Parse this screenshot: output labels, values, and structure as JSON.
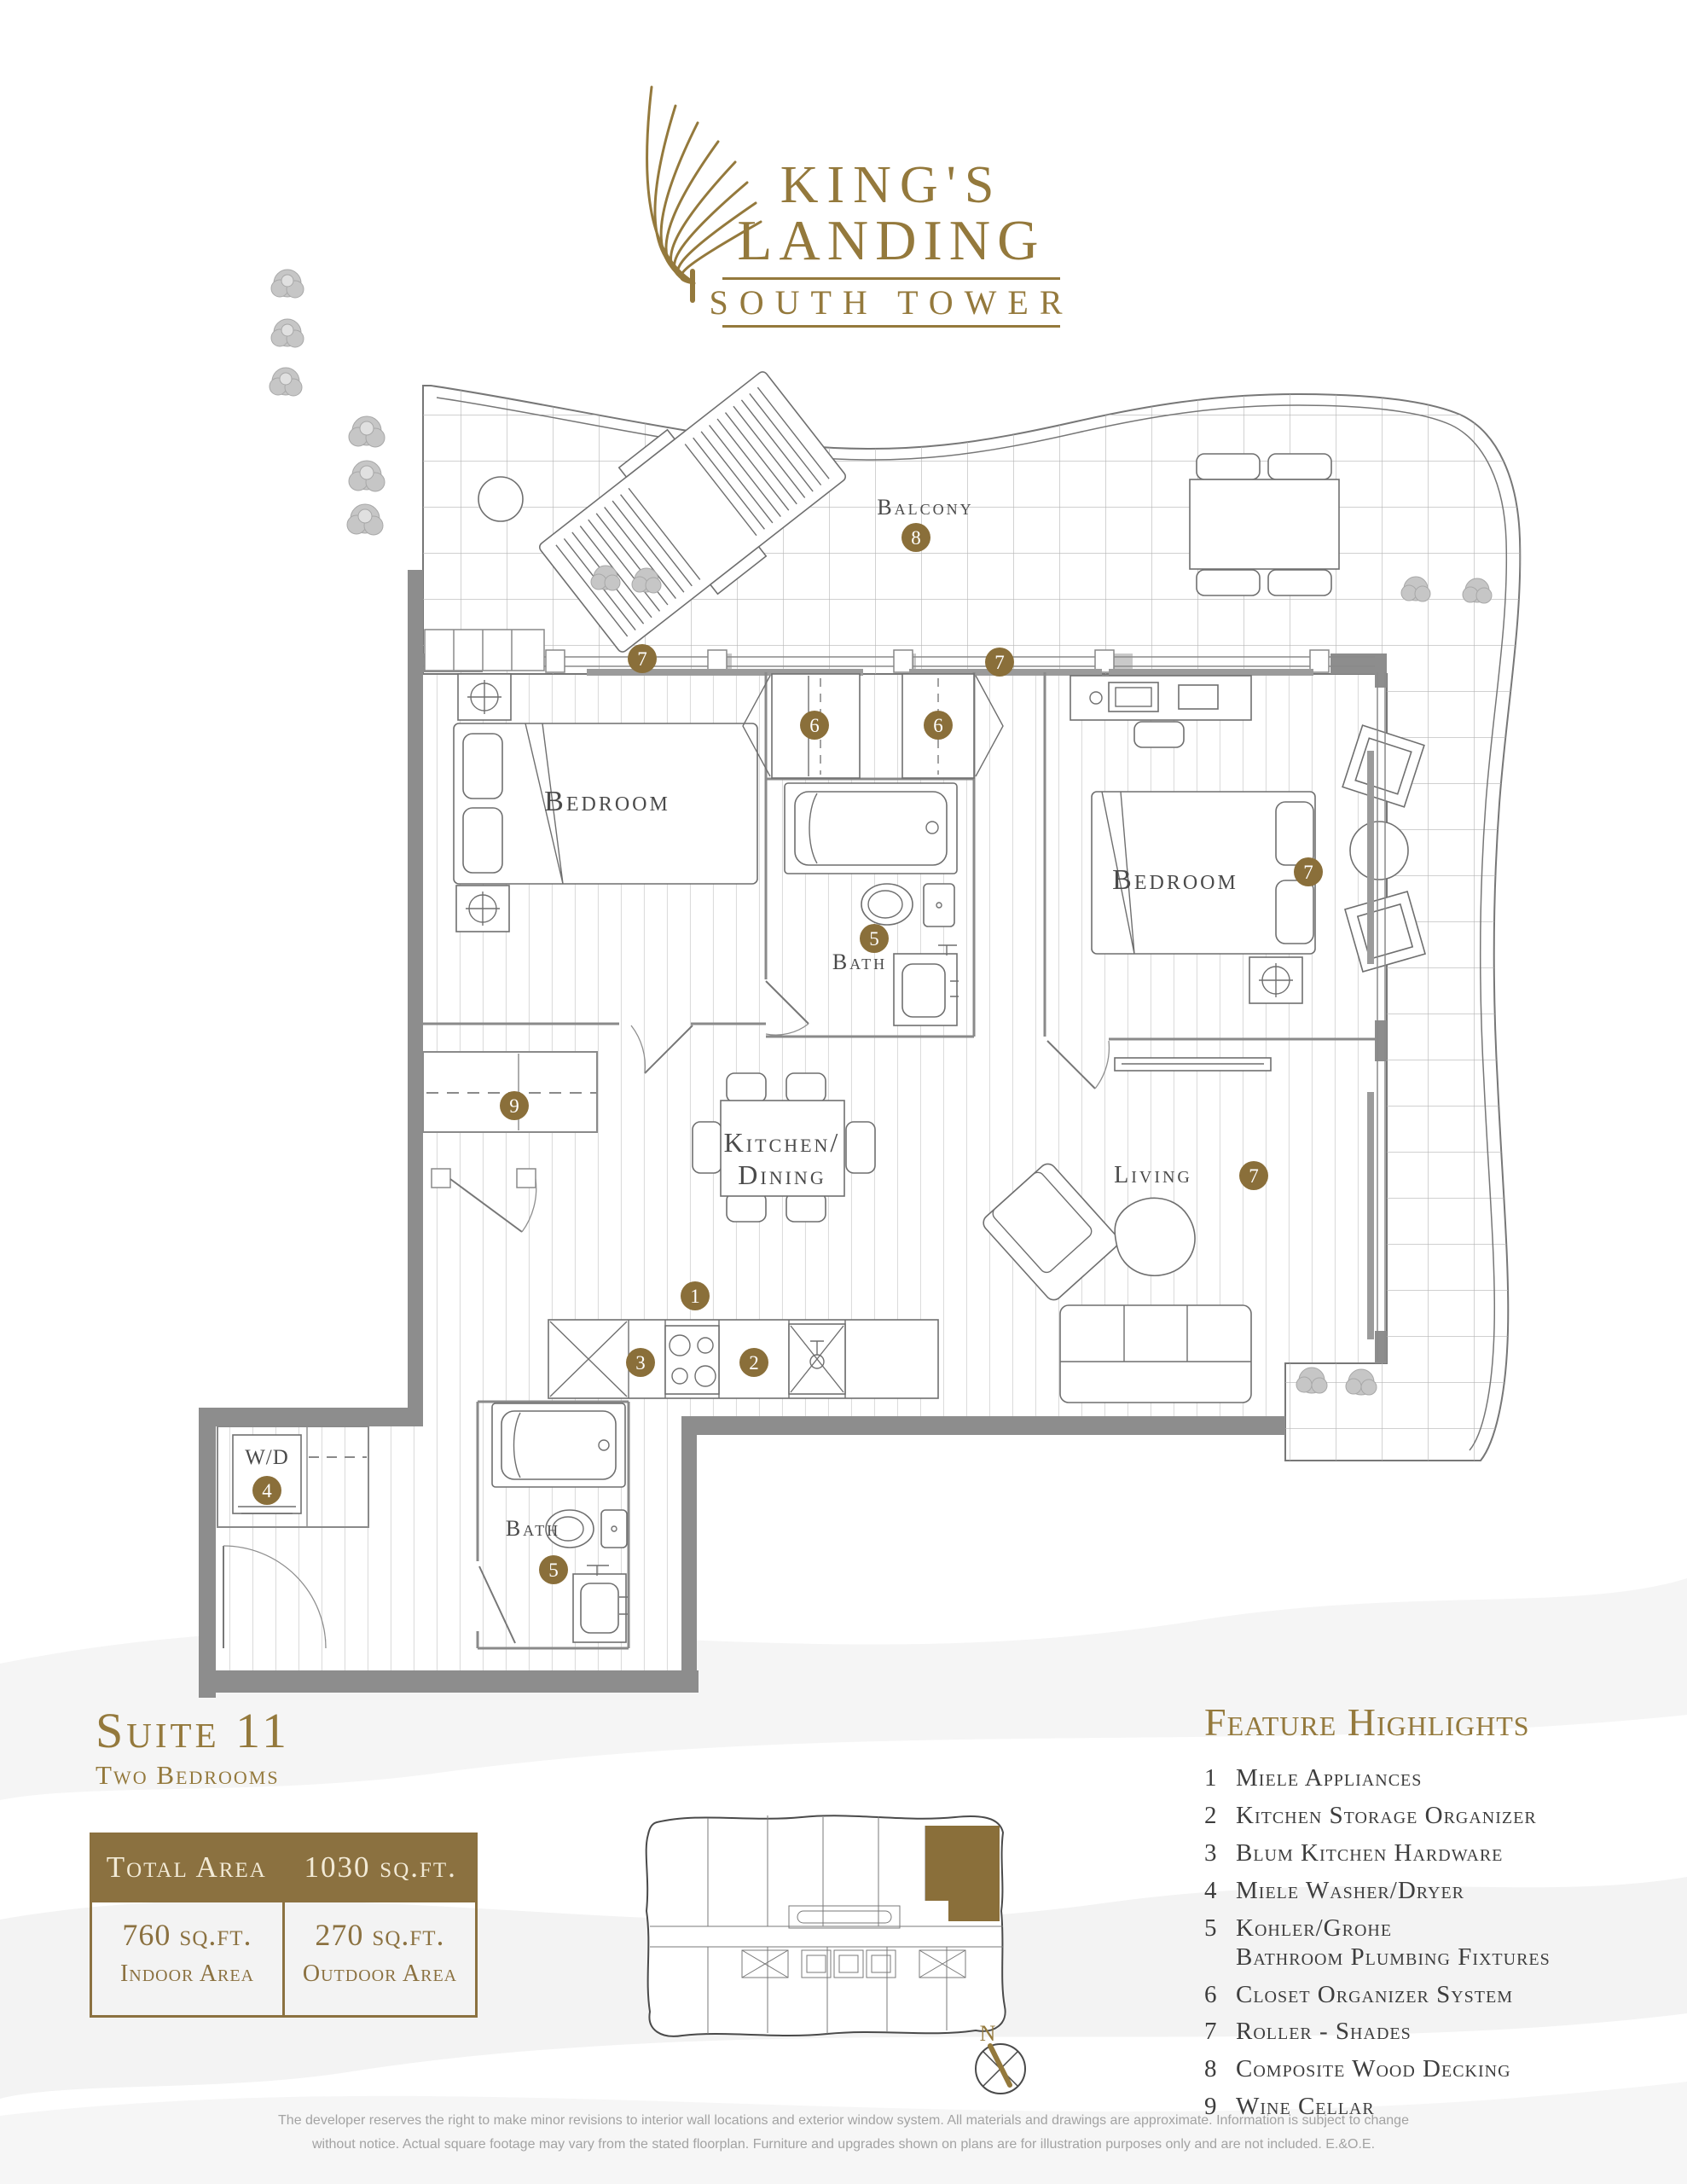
{
  "brand": {
    "line1": "KING'S",
    "line2": "LANDING",
    "subtitle": "SOUTH TOWER"
  },
  "plan": {
    "labels": {
      "balcony": "Balcony",
      "bedroom_left": "Bedroom",
      "bedroom_right": "Bedroom",
      "bath_upper": "Bath",
      "bath_lower": "Bath",
      "kitchen_line1": "Kitchen/",
      "kitchen_line2": "Dining",
      "living": "Living",
      "washer_dryer": "W/D"
    },
    "marker_numbers": {
      "n1": "1",
      "n2": "2",
      "n3": "3",
      "n4": "4",
      "n5": "5",
      "n6": "6",
      "n7": "7",
      "n8": "8",
      "n9": "9"
    }
  },
  "suite": {
    "title": "Suite 11",
    "subtitle": "Two Bedrooms"
  },
  "area_table": {
    "header_label": "Total Area",
    "header_value": "1030 sq.ft.",
    "indoor_value": "760 sq.ft.",
    "indoor_label": "Indoor Area",
    "outdoor_value": "270 sq.ft.",
    "outdoor_label": "Outdoor Area"
  },
  "features": {
    "title": "Feature Highlights",
    "items": [
      {
        "num": "1",
        "label": "Miele Appliances"
      },
      {
        "num": "2",
        "label": "Kitchen Storage Organizer"
      },
      {
        "num": "3",
        "label": "Blum Kitchen Hardware"
      },
      {
        "num": "4",
        "label": "Miele Washer/Dryer"
      },
      {
        "num": "5",
        "label": "Kohler/Grohe\nBathroom Plumbing Fixtures"
      },
      {
        "num": "6",
        "label": "Closet Organizer System"
      },
      {
        "num": "7",
        "label": "Roller - Shades"
      },
      {
        "num": "8",
        "label": "Composite Wood Decking"
      },
      {
        "num": "9",
        "label": "Wine Cellar"
      }
    ]
  },
  "compass": {
    "north_label": "N"
  },
  "footer": {
    "line1": "The developer reserves the right to make minor revisions to interior wall locations and exterior window system. All materials and drawings are approximate. Information is subject to change",
    "line2": "without notice. Actual square footage may vary from the stated floorplan. Furniture and upgrades shown on plans are for illustration purposes only and are not included. E.&O.E."
  },
  "colors": {
    "gold": "#94793c",
    "gold_dark": "#8b7140",
    "marker_gold": "#8a6f3a",
    "wall_gray": "#8d8d8d"
  }
}
